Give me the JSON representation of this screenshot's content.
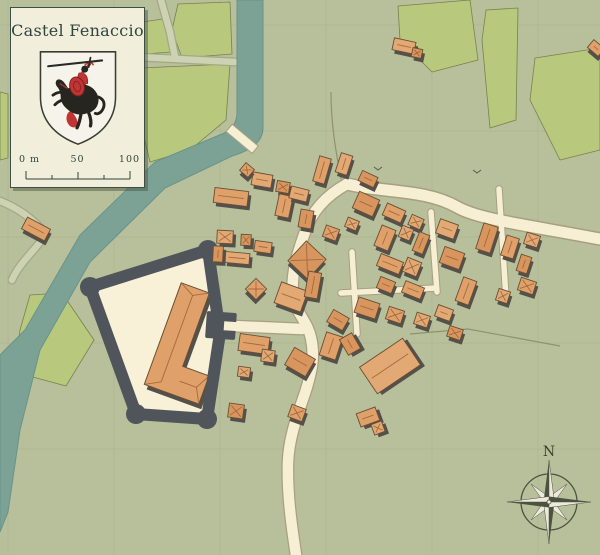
{
  "card": {
    "title": "Castel Fenaccio",
    "crest_icon": "knight-crest-icon",
    "scale": {
      "start": "0 m",
      "mid": "50",
      "end": "100"
    }
  },
  "compass": {
    "north_label": "N",
    "icon": "compass-rose-icon"
  },
  "palette": {
    "base": "#b8bf9b",
    "field": "#b8c87c",
    "fieldStroke": "#75834d",
    "path": "#cdd2b2",
    "pathStroke": "#a3a887",
    "river": "#7ba295",
    "riverEdge": "#699389",
    "road": "#f6efd4",
    "roadStroke": "#a89f80",
    "bld1": "#dfa069",
    "bld2": "#e3a974",
    "bld3": "#d8965e",
    "bldStroke": "#6a4e33",
    "bldRidge": "#9a6238",
    "bldShadow": "#53514a",
    "wall": "#50555b",
    "courtyard": "#f8f1d7",
    "cardBg": "#f1eedb",
    "cardBorder": "#3e4f44",
    "ink": "#2e463c",
    "grid": "#a6af89",
    "compassDark": "#4b5340",
    "compassLight": "#eeeadb",
    "crestRed": "#c13434",
    "crestBlack": "#26251f",
    "shieldBg": "#f5f3ea"
  },
  "map": {
    "buildings": [
      [
        231,
        197,
        34,
        15,
        7
      ],
      [
        262,
        180,
        20,
        13,
        10
      ],
      [
        283,
        187,
        13,
        11,
        10
      ],
      [
        247,
        170,
        11,
        10,
        40
      ],
      [
        225,
        237,
        16,
        13,
        3
      ],
      [
        246,
        240,
        10,
        11,
        3
      ],
      [
        263,
        247,
        17,
        11,
        8
      ],
      [
        237,
        258,
        25,
        11,
        5
      ],
      [
        218,
        254,
        10,
        16,
        3
      ],
      [
        284,
        206,
        14,
        22,
        12
      ],
      [
        299,
        194,
        18,
        12,
        14
      ],
      [
        306,
        219,
        13,
        18,
        10
      ],
      [
        322,
        170,
        12,
        26,
        16
      ],
      [
        344,
        164,
        12,
        20,
        18
      ],
      [
        307,
        260,
        27,
        27,
        43
      ],
      [
        331,
        233,
        14,
        12,
        20
      ],
      [
        352,
        224,
        12,
        10,
        22
      ],
      [
        366,
        204,
        22,
        18,
        24
      ],
      [
        394,
        213,
        20,
        13,
        24
      ],
      [
        416,
        222,
        13,
        11,
        24
      ],
      [
        368,
        179,
        17,
        11,
        25
      ],
      [
        385,
        238,
        15,
        22,
        22
      ],
      [
        406,
        233,
        12,
        12,
        22
      ],
      [
        421,
        243,
        11,
        20,
        22
      ],
      [
        390,
        264,
        24,
        13,
        22
      ],
      [
        412,
        267,
        15,
        15,
        22
      ],
      [
        386,
        285,
        16,
        12,
        22
      ],
      [
        413,
        290,
        20,
        12,
        22
      ],
      [
        447,
        229,
        19,
        15,
        20
      ],
      [
        452,
        258,
        21,
        17,
        20
      ],
      [
        466,
        291,
        14,
        25,
        20
      ],
      [
        444,
        313,
        16,
        12,
        20
      ],
      [
        487,
        238,
        15,
        27,
        18
      ],
      [
        510,
        247,
        13,
        21,
        18
      ],
      [
        532,
        240,
        14,
        12,
        18
      ],
      [
        524,
        264,
        11,
        17,
        18
      ],
      [
        527,
        286,
        16,
        13,
        18
      ],
      [
        503,
        296,
        12,
        12,
        18
      ],
      [
        367,
        308,
        22,
        16,
        18
      ],
      [
        395,
        315,
        16,
        13,
        18
      ],
      [
        422,
        320,
        14,
        12,
        18
      ],
      [
        338,
        320,
        18,
        14,
        30
      ],
      [
        256,
        289,
        15,
        15,
        45
      ],
      [
        291,
        297,
        28,
        22,
        20
      ],
      [
        313,
        285,
        13,
        26,
        10
      ],
      [
        254,
        344,
        30,
        17,
        8
      ],
      [
        268,
        356,
        13,
        12,
        8
      ],
      [
        300,
        362,
        24,
        20,
        30
      ],
      [
        331,
        346,
        17,
        24,
        18
      ],
      [
        390,
        366,
        52,
        32,
        -34
      ],
      [
        350,
        344,
        14,
        18,
        -30
      ],
      [
        368,
        417,
        20,
        14,
        -20
      ],
      [
        378,
        428,
        11,
        11,
        -20
      ],
      [
        236,
        411,
        15,
        14,
        8
      ],
      [
        297,
        413,
        15,
        13,
        20
      ],
      [
        244,
        372,
        12,
        10,
        8
      ],
      [
        455,
        333,
        14,
        11,
        18
      ],
      [
        36,
        229,
        26,
        13,
        28
      ],
      [
        404,
        46,
        22,
        12,
        12
      ],
      [
        417,
        53,
        10,
        9,
        12
      ],
      [
        596,
        48,
        14,
        10,
        40
      ]
    ]
  }
}
